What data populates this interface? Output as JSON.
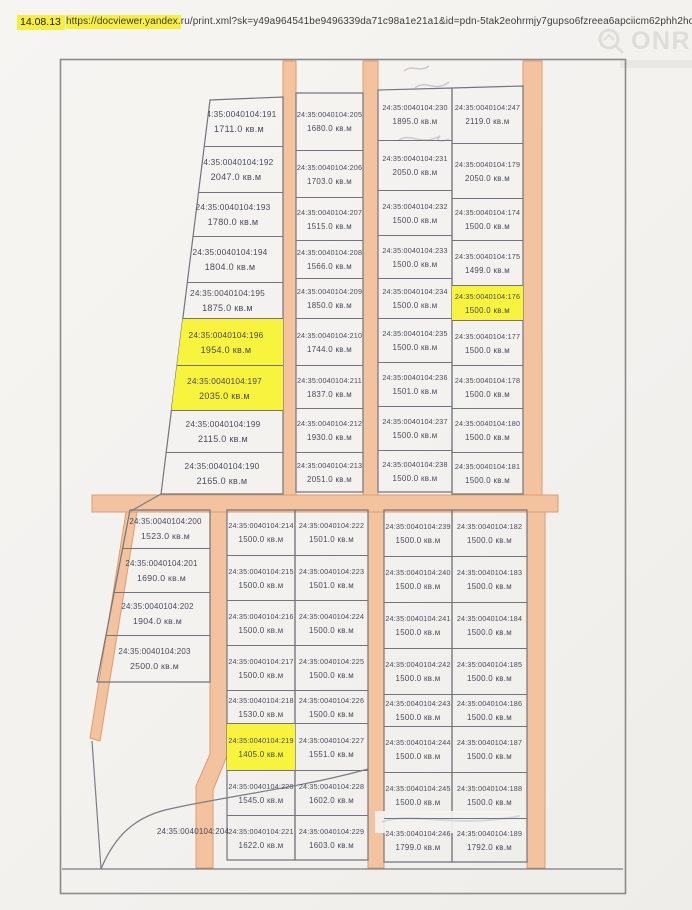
{
  "header": {
    "date": "14.08.13",
    "url_highlighted": "https://docviewer.yandex.",
    "url_rest": "ru/print.xml?sk=y49a964541be9496339da71c98a1e21a1&id=pdn-5tak2eohrmjy7gupso6fzreea6apciicm62phh2hoew0w333i7m5...",
    "watermark": "ONREALT"
  },
  "map": {
    "cadastral_prefix": "24:35:0040104:",
    "area_unit": "кв.м",
    "highlight_color": "#f8f43e",
    "road_color": "#f2c39e",
    "columns": [
      {
        "id": "top-left",
        "plots": [
          {
            "num": "191",
            "area": "1711.0"
          },
          {
            "num": "192",
            "area": "2047.0"
          },
          {
            "num": "193",
            "area": "1780.0"
          },
          {
            "num": "194",
            "area": "1804.0"
          },
          {
            "num": "195",
            "area": "1875.0"
          },
          {
            "num": "196",
            "area": "1954.0",
            "highlight": true
          },
          {
            "num": "197",
            "area": "2035.0",
            "highlight": true
          },
          {
            "num": "199",
            "area": "2115.0"
          },
          {
            "num": "190",
            "area": "2165.0"
          }
        ]
      },
      {
        "id": "top-mid-left",
        "plots": [
          {
            "num": "205",
            "area": "1680.0"
          },
          {
            "num": "206",
            "area": "1703.0"
          },
          {
            "num": "207",
            "area": "1515.0"
          },
          {
            "num": "208",
            "area": "1566.0"
          },
          {
            "num": "209",
            "area": "1850.0"
          },
          {
            "num": "210",
            "area": "1744.0"
          },
          {
            "num": "211",
            "area": "1837.0"
          },
          {
            "num": "212",
            "area": "1930.0"
          },
          {
            "num": "213",
            "area": "2051.0"
          }
        ]
      },
      {
        "id": "top-mid-right",
        "plots": [
          {
            "num": "230",
            "area": "1895.0"
          },
          {
            "num": "231",
            "area": "2050.0"
          },
          {
            "num": "232",
            "area": "1500.0"
          },
          {
            "num": "233",
            "area": "1500.0"
          },
          {
            "num": "234",
            "area": "1500.0"
          },
          {
            "num": "235",
            "area": "1500.0"
          },
          {
            "num": "236",
            "area": "1501.0"
          },
          {
            "num": "237",
            "area": "1500.0"
          },
          {
            "num": "238",
            "area": "1500.0"
          }
        ]
      },
      {
        "id": "top-right",
        "plots": [
          {
            "num": "247",
            "area": "2119.0"
          },
          {
            "num": "179",
            "area": "2050.0"
          },
          {
            "num": "174",
            "area": "1500.0"
          },
          {
            "num": "175",
            "area": "1499.0"
          },
          {
            "num": "176",
            "area": "1500.0",
            "highlight": true
          },
          {
            "num": "177",
            "area": "1500.0"
          },
          {
            "num": "178",
            "area": "1500.0"
          },
          {
            "num": "180",
            "area": "1500.0"
          },
          {
            "num": "181",
            "area": "1500.0"
          }
        ]
      },
      {
        "id": "bottom-left",
        "plots": [
          {
            "num": "200",
            "area": "1523.0"
          },
          {
            "num": "201",
            "area": "1690.0"
          },
          {
            "num": "202",
            "area": "1904.0"
          },
          {
            "num": "203",
            "area": "2500.0"
          }
        ]
      },
      {
        "id": "bottom-mid-left",
        "plots": [
          {
            "num": "214",
            "area": "1500.0"
          },
          {
            "num": "215",
            "area": "1500.0"
          },
          {
            "num": "216",
            "area": "1500.0"
          },
          {
            "num": "217",
            "area": "1500.0"
          },
          {
            "num": "218",
            "area": "1530.0"
          },
          {
            "num": "219",
            "area": "1405.0",
            "highlight": true
          },
          {
            "num": "220",
            "area": "1545.0"
          },
          {
            "num": "221",
            "area": "1622.0"
          }
        ]
      },
      {
        "id": "bottom-mid",
        "plots": [
          {
            "num": "222",
            "area": "1501.0"
          },
          {
            "num": "223",
            "area": "1501.0"
          },
          {
            "num": "224",
            "area": "1500.0"
          },
          {
            "num": "225",
            "area": "1500.0"
          },
          {
            "num": "226",
            "area": "1500.0"
          },
          {
            "num": "227",
            "area": "1551.0"
          },
          {
            "num": "228",
            "area": "1602.0"
          },
          {
            "num": "229",
            "area": "1603.0"
          }
        ]
      },
      {
        "id": "bottom-mid-right",
        "plots": [
          {
            "num": "239",
            "area": "1500.0"
          },
          {
            "num": "240",
            "area": "1500.0"
          },
          {
            "num": "241",
            "area": "1500.0"
          },
          {
            "num": "242",
            "area": "1500.0"
          },
          {
            "num": "243",
            "area": "1500.0"
          },
          {
            "num": "244",
            "area": "1500.0"
          },
          {
            "num": "245",
            "area": "1500.0"
          },
          {
            "num": "246",
            "area": "1799.0"
          }
        ]
      },
      {
        "id": "bottom-right",
        "plots": [
          {
            "num": "182",
            "area": "1500.0"
          },
          {
            "num": "183",
            "area": "1500.0"
          },
          {
            "num": "184",
            "area": "1500.0"
          },
          {
            "num": "185",
            "area": "1500.0"
          },
          {
            "num": "186",
            "area": "1500.0"
          },
          {
            "num": "187",
            "area": "1500.0"
          },
          {
            "num": "188",
            "area": "1500.0"
          },
          {
            "num": "189",
            "area": "1792.0"
          }
        ]
      }
    ],
    "standalone_plot": {
      "num": "204"
    }
  }
}
